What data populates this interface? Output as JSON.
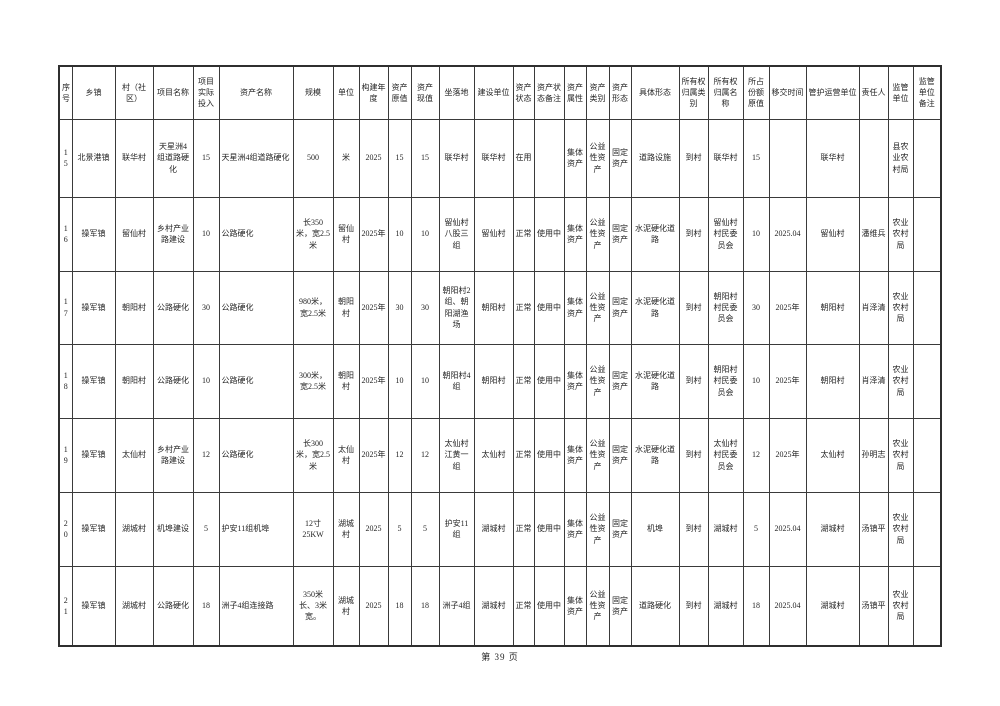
{
  "page": {
    "footer": "第 39 页"
  },
  "table": {
    "columns": [
      "序号",
      "乡镇",
      "村（社区）",
      "项目名称",
      "项目实际投入",
      "资产名称",
      "规模",
      "单位",
      "构建年度",
      "资产原值",
      "资产现值",
      "坐落地",
      "建设单位",
      "资产状态",
      "资产状态备注",
      "资产属性",
      "资产类别",
      "资产形态",
      "具体形态",
      "所有权归属类别",
      "所有权归属名称",
      "所占份额原值",
      "移交时间",
      "管护运营单位",
      "责任人",
      "监管单位",
      "监管单位备注"
    ],
    "rows": [
      [
        "15",
        "北景港镇",
        "联华村",
        "天星洲4组道路硬化",
        "15",
        "天星洲4组道路硬化",
        "500",
        "米",
        "2025",
        "15",
        "15",
        "联华村",
        "联华村",
        "在用",
        "",
        "集体资产",
        "公益性资产",
        "固定资产",
        "道路设施",
        "到村",
        "联华村",
        "15",
        "",
        "联华村",
        "",
        "县农业农村局",
        ""
      ],
      [
        "16",
        "操军镇",
        "留仙村",
        "乡村产业路建设",
        "10",
        "公路硬化",
        "长350米，宽2.5米",
        "留仙村",
        "2025年",
        "10",
        "10",
        "留仙村八股三组",
        "留仙村",
        "正常",
        "使用中",
        "集体资产",
        "公益性资产",
        "固定资产",
        "水泥硬化道路",
        "到村",
        "留仙村村民委员会",
        "10",
        "2025.04",
        "留仙村",
        "潘维兵",
        "农业农村局",
        ""
      ],
      [
        "17",
        "操军镇",
        "朝阳村",
        "公路硬化",
        "30",
        "公路硬化",
        "980米，宽2.5米",
        "朝阳村",
        "2025年",
        "30",
        "30",
        "朝阳村2组、朝阳湖渔场",
        "朝阳村",
        "正常",
        "使用中",
        "集体资产",
        "公益性资产",
        "固定资产",
        "水泥硬化道路",
        "到村",
        "朝阳村村民委员会",
        "30",
        "2025年",
        "朝阳村",
        "肖泽清",
        "农业农村局",
        ""
      ],
      [
        "18",
        "操军镇",
        "朝阳村",
        "公路硬化",
        "10",
        "公路硬化",
        "300米，宽2.5米",
        "朝阳村",
        "2025年",
        "10",
        "10",
        "朝阳村4组",
        "朝阳村",
        "正常",
        "使用中",
        "集体资产",
        "公益性资产",
        "固定资产",
        "水泥硬化道路",
        "到村",
        "朝阳村村民委员会",
        "10",
        "2025年",
        "朝阳村",
        "肖泽清",
        "农业农村局",
        ""
      ],
      [
        "19",
        "操军镇",
        "太仙村",
        "乡村产业路建设",
        "12",
        "公路硬化",
        "长300米，宽2.5米",
        "太仙村",
        "2025年",
        "12",
        "12",
        "太仙村江黄一组",
        "太仙村",
        "正常",
        "使用中",
        "集体资产",
        "公益性资产",
        "固定资产",
        "水泥硬化道路",
        "到村",
        "太仙村村民委员会",
        "12",
        "2025年",
        "太仙村",
        "孙明志",
        "农业农村局",
        ""
      ],
      [
        "20",
        "操军镇",
        "湖城村",
        "机埠建设",
        "5",
        "护安11组机埠",
        "12寸25KW",
        "湖城村",
        "2025",
        "5",
        "5",
        "护安11组",
        "湖城村",
        "正常",
        "使用中",
        "集体资产",
        "公益性资产",
        "固定资产",
        "机埠",
        "到村",
        "湖城村",
        "5",
        "2025.04",
        "湖城村",
        "汤镇平",
        "农业农村局",
        ""
      ],
      [
        "21",
        "操军镇",
        "湖城村",
        "公路硬化",
        "18",
        "洲子4组连接路",
        "350米长、3米宽。",
        "湖城村",
        "2025",
        "18",
        "18",
        "洲子4组",
        "湖城村",
        "正常",
        "使用中",
        "集体资产",
        "公益性资产",
        "固定资产",
        "道路硬化",
        "到村",
        "湖城村",
        "18",
        "2025.04",
        "湖城村",
        "汤镇平",
        "农业农村局",
        ""
      ]
    ]
  }
}
